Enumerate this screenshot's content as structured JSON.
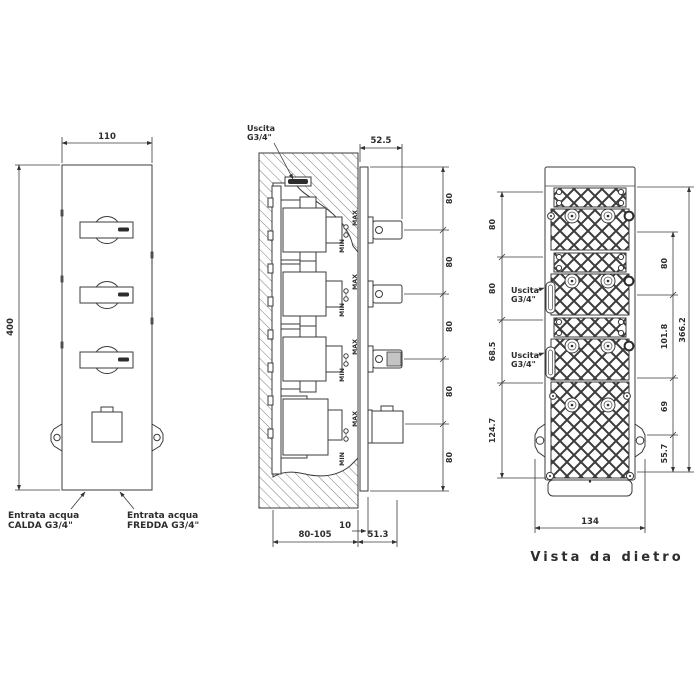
{
  "drawing": {
    "colors": {
      "line": "#3b3b3b",
      "text": "#2d2d2d",
      "background": "#ffffff"
    },
    "front": {
      "dim_width": "110",
      "dim_height": "400",
      "hot_inlet": {
        "line1": "Entrata acqua",
        "line2": "CALDA G3/4\""
      },
      "cold_inlet": {
        "line1": "Entrata acqua",
        "line2": "FREDDA G3/4\""
      }
    },
    "side": {
      "outlet": {
        "line1": "Uscita",
        "line2": "G3/4\""
      },
      "dim_handle": "52.5",
      "dims_spacing": [
        "80",
        "80",
        "80",
        "80",
        "80"
      ],
      "max": "MAX",
      "min": "MIN",
      "dim_plate_thickness": "10",
      "dim_recess_depth": "80-105",
      "dim_protrusion": "51.3"
    },
    "back": {
      "outlet1": {
        "line1": "Uscita",
        "line2": "G3/4\""
      },
      "outlet2": {
        "line1": "Uscita",
        "line2": "G3/4\""
      },
      "dims_left": [
        "80",
        "80",
        "68.5",
        "124.7"
      ],
      "dims_right": [
        "80",
        "101.8",
        "69",
        "55.7"
      ],
      "dim_total_height": "366.2",
      "dim_width": "134",
      "caption": "Vista da dietro"
    }
  }
}
